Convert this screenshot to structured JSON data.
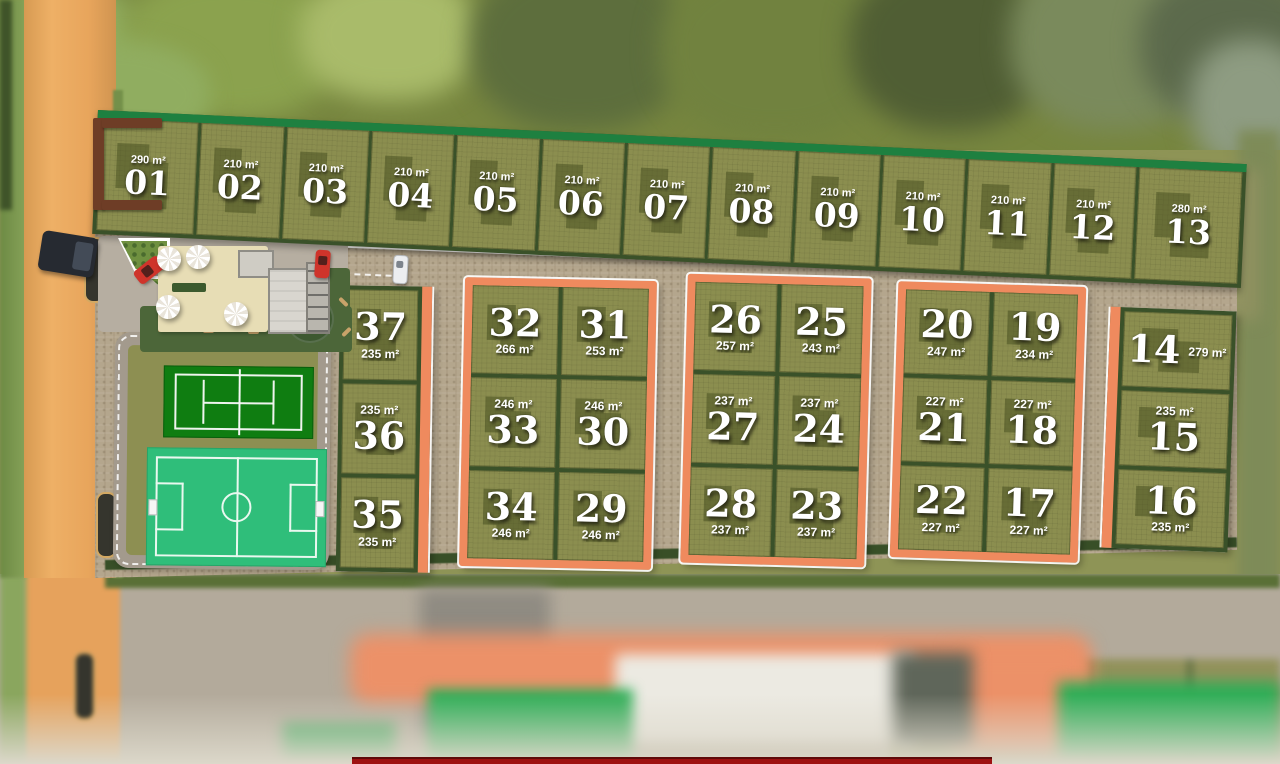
{
  "colors": {
    "sidewalk_salmon": "#ef8a5e",
    "lot_olive": "#8b8e4f",
    "building_footprint": "#444b1e",
    "hedge_dark": "#3a5129",
    "hedge_bright": "#1e8040",
    "pavement": "#b4a68d",
    "tennis_green": "#0f7d11",
    "soccer_green": "#2fbe7a",
    "dirt_road": "#e8a55c",
    "banner_red": "#9e1111"
  },
  "lots": {
    "t": [
      {
        "num": "01",
        "area": "290 m²"
      },
      {
        "num": "02",
        "area": "210 m²"
      },
      {
        "num": "03",
        "area": "210 m²"
      },
      {
        "num": "04",
        "area": "210 m²"
      },
      {
        "num": "05",
        "area": "210 m²"
      },
      {
        "num": "06",
        "area": "210 m²"
      },
      {
        "num": "07",
        "area": "210 m²"
      },
      {
        "num": "08",
        "area": "210 m²"
      },
      {
        "num": "09",
        "area": "210 m²"
      },
      {
        "num": "10",
        "area": "210 m²"
      },
      {
        "num": "11",
        "area": "210 m²"
      },
      {
        "num": "12",
        "area": "210 m²"
      },
      {
        "num": "13",
        "area": "280 m²"
      }
    ],
    "a": [
      {
        "num": "37",
        "area": "235 m²"
      },
      {
        "num": "36",
        "area": "235 m²"
      },
      {
        "num": "35",
        "area": "235 m²"
      }
    ],
    "b": [
      {
        "num": "32",
        "area": "266 m²"
      },
      {
        "num": "31",
        "area": "253 m²"
      },
      {
        "num": "33",
        "area": "246 m²"
      },
      {
        "num": "30",
        "area": "246 m²"
      },
      {
        "num": "34",
        "area": "246 m²"
      },
      {
        "num": "29",
        "area": "246 m²"
      }
    ],
    "c": [
      {
        "num": "26",
        "area": "257 m²"
      },
      {
        "num": "25",
        "area": "243 m²"
      },
      {
        "num": "27",
        "area": "237 m²"
      },
      {
        "num": "24",
        "area": "237 m²"
      },
      {
        "num": "28",
        "area": "237 m²"
      },
      {
        "num": "23",
        "area": "237 m²"
      }
    ],
    "d": [
      {
        "num": "20",
        "area": "247 m²"
      },
      {
        "num": "19",
        "area": "234 m²"
      },
      {
        "num": "21",
        "area": "227 m²"
      },
      {
        "num": "18",
        "area": "227 m²"
      },
      {
        "num": "22",
        "area": "227 m²"
      },
      {
        "num": "17",
        "area": "227 m²"
      }
    ],
    "e": [
      {
        "num": "14",
        "area": "279 m²"
      },
      {
        "num": "15",
        "area": "235 m²"
      },
      {
        "num": "16",
        "area": "235 m²"
      }
    ]
  }
}
